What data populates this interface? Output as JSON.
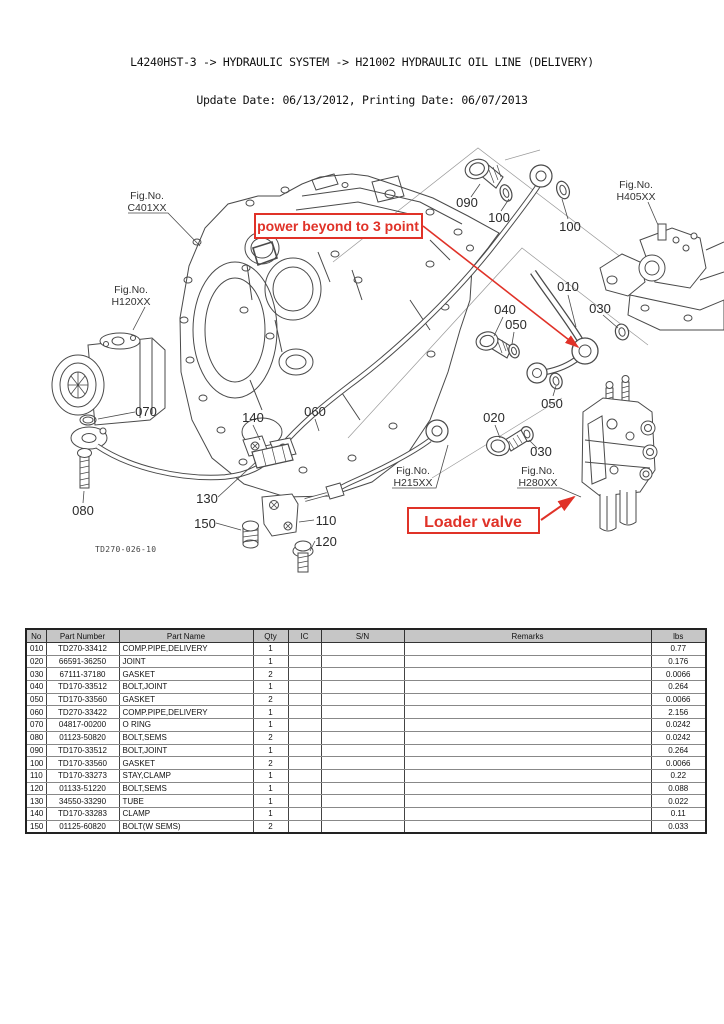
{
  "page": {
    "title": "L4240HST-3 -> HYDRAULIC SYSTEM -> H21002 HYDRAULIC OIL LINE (DELIVERY)",
    "subtitle": "Update Date: 06/13/2012, Printing Date: 06/07/2013"
  },
  "diagram": {
    "drawing_number": "TD270-026-10",
    "annotations": {
      "power_beyond": "power beyond to 3 point",
      "loader_valve": "Loader valve"
    },
    "colors": {
      "annotation_red": "#e03228",
      "line_gray": "#4a4a4a"
    },
    "fig_labels": [
      {
        "prefix": "Fig.No.",
        "code": "C401XX"
      },
      {
        "prefix": "Fig.No.",
        "code": "H120XX"
      },
      {
        "prefix": "Fig.No.",
        "code": "H405XX"
      },
      {
        "prefix": "Fig.No.",
        "code": "H215XX"
      },
      {
        "prefix": "Fig.No.",
        "code": "H280XX"
      }
    ],
    "part_labels": [
      "090",
      "100",
      "100",
      "010",
      "030",
      "040",
      "050",
      "050",
      "020",
      "030",
      "070",
      "080",
      "140",
      "060",
      "130",
      "150",
      "110",
      "120"
    ]
  },
  "table": {
    "columns": [
      "No",
      "Part Number",
      "Part Name",
      "Qty",
      "IC",
      "S/N",
      "Remarks",
      "lbs"
    ],
    "rows": [
      {
        "no": "010",
        "part_number": "TD270-33412",
        "part_name": "COMP.PIPE,DELIVERY",
        "qty": "1",
        "ic": "",
        "sn": "",
        "remarks": "",
        "lbs": "0.77"
      },
      {
        "no": "020",
        "part_number": "66591-36250",
        "part_name": "JOINT",
        "qty": "1",
        "ic": "",
        "sn": "",
        "remarks": "",
        "lbs": "0.176"
      },
      {
        "no": "030",
        "part_number": "67111-37180",
        "part_name": "GASKET",
        "qty": "2",
        "ic": "",
        "sn": "",
        "remarks": "",
        "lbs": "0.0066"
      },
      {
        "no": "040",
        "part_number": "TD170-33512",
        "part_name": "BOLT,JOINT",
        "qty": "1",
        "ic": "",
        "sn": "",
        "remarks": "",
        "lbs": "0.264"
      },
      {
        "no": "050",
        "part_number": "TD170-33560",
        "part_name": "GASKET",
        "qty": "2",
        "ic": "",
        "sn": "",
        "remarks": "",
        "lbs": "0.0066"
      },
      {
        "no": "060",
        "part_number": "TD270-33422",
        "part_name": "COMP.PIPE,DELIVERY",
        "qty": "1",
        "ic": "",
        "sn": "",
        "remarks": "",
        "lbs": "2.156"
      },
      {
        "no": "070",
        "part_number": "04817-00200",
        "part_name": "O RING",
        "qty": "1",
        "ic": "",
        "sn": "",
        "remarks": "",
        "lbs": "0.0242"
      },
      {
        "no": "080",
        "part_number": "01123-50820",
        "part_name": "BOLT,SEMS",
        "qty": "2",
        "ic": "",
        "sn": "",
        "remarks": "",
        "lbs": "0.0242"
      },
      {
        "no": "090",
        "part_number": "TD170-33512",
        "part_name": "BOLT,JOINT",
        "qty": "1",
        "ic": "",
        "sn": "",
        "remarks": "",
        "lbs": "0.264"
      },
      {
        "no": "100",
        "part_number": "TD170-33560",
        "part_name": "GASKET",
        "qty": "2",
        "ic": "",
        "sn": "",
        "remarks": "",
        "lbs": "0.0066"
      },
      {
        "no": "110",
        "part_number": "TD170-33273",
        "part_name": "STAY,CLAMP",
        "qty": "1",
        "ic": "",
        "sn": "",
        "remarks": "",
        "lbs": "0.22"
      },
      {
        "no": "120",
        "part_number": "01133-51220",
        "part_name": "BOLT,SEMS",
        "qty": "1",
        "ic": "",
        "sn": "",
        "remarks": "",
        "lbs": "0.088"
      },
      {
        "no": "130",
        "part_number": "34550-33290",
        "part_name": "TUBE",
        "qty": "1",
        "ic": "",
        "sn": "",
        "remarks": "",
        "lbs": "0.022"
      },
      {
        "no": "140",
        "part_number": "TD170-33283",
        "part_name": "CLAMP",
        "qty": "1",
        "ic": "",
        "sn": "",
        "remarks": "",
        "lbs": "0.11"
      },
      {
        "no": "150",
        "part_number": "01125-60820",
        "part_name": "BOLT(W SEMS)",
        "qty": "2",
        "ic": "",
        "sn": "",
        "remarks": "",
        "lbs": "0.033"
      }
    ]
  }
}
